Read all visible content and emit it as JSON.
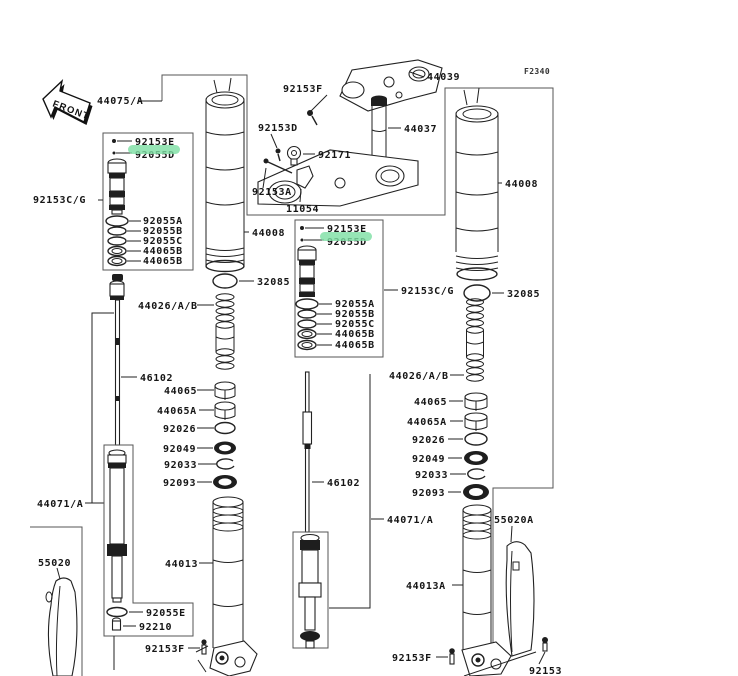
{
  "meta": {
    "page_code": "F2340",
    "front_label": "FRONT",
    "highlight_color": "#7fdfa5"
  },
  "left_fork": {
    "assembly_label": "44075/A",
    "cartridge_group_label": "92153C/G",
    "cartridge": {
      "screw_label": "92153E",
      "valve_label": "92055D",
      "ring_labels": [
        "92055A",
        "92055B",
        "92055C",
        "44065B",
        "44065B"
      ]
    },
    "inner_tube_label": "44008",
    "base_ring_label": "32085",
    "spring_label": "44026/A/B",
    "rod_label": "46102",
    "damper_label": "44071/A",
    "stack_labels": [
      "44065",
      "44065A",
      "92026",
      "92049",
      "92033",
      "92093"
    ],
    "outer_tube_label": "44013",
    "drain_gasket_label": "92055E",
    "drain_screw_label": "92210",
    "guard_label": "55020",
    "axle_bolt_label": "92153F"
  },
  "steering": {
    "pinch_bolt_label": "92153F",
    "upper_clamp_label": "44039",
    "stem_label": "44037",
    "screw_label": "92153D",
    "clamp_label": "92171",
    "bolt_label": "92153A",
    "bracket_label": "11054"
  },
  "right_fork": {
    "cartridge_group_label": "92153C/G",
    "cartridge": {
      "screw_label": "92153E",
      "valve_label": "92055D",
      "ring_labels": [
        "92055A",
        "92055B",
        "92055C",
        "44065B",
        "44065B"
      ]
    },
    "inner_tube_label": "44008",
    "base_ring_label": "32085",
    "spring_label": "44026/A/B",
    "rod_label": "46102",
    "damper_label": "44071/A",
    "stack_labels": [
      "44065",
      "44065A",
      "92026",
      "92049",
      "92033",
      "92093"
    ],
    "outer_tube_label": "44013A",
    "guard_label": "55020A",
    "pinch_bolt_label": "92153F",
    "axle_bolt_label": "92153"
  }
}
